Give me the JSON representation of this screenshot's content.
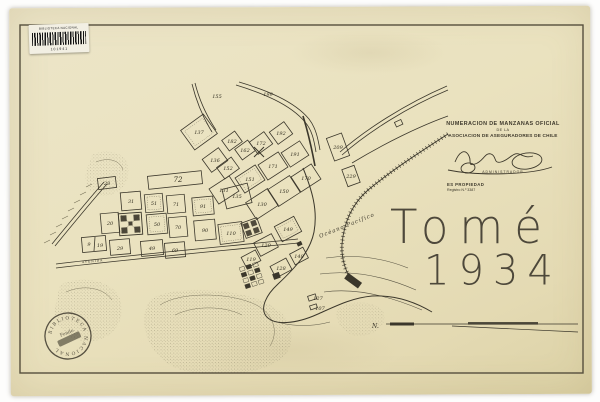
{
  "header": {
    "barcode_sticker": {
      "title": "BIBLIOTECA NACIONAL",
      "number": "101941"
    },
    "title_block": {
      "line1": "NUMERACION DE MANZANAS OFICIAL",
      "line2": "DE LA",
      "line3": "ASOCIACION DE ASEGURADORES DE CHILE",
      "signature_caption": "ADMINISTRADOR",
      "property_notice": "ES PROPIEDAD",
      "registry": "Registro N.º 3387"
    }
  },
  "map": {
    "title": "Tomé",
    "year": "1934",
    "ocean_label": "Océano Pacífico",
    "street_label": "AVENIDA",
    "north_label": "N.",
    "blocks": [
      {
        "n": "28",
        "x": 107,
        "y": 185
      },
      {
        "n": "72",
        "x": 178,
        "y": 182,
        "s": 7
      },
      {
        "n": "31",
        "x": 131,
        "y": 203
      },
      {
        "n": "51",
        "x": 154,
        "y": 205
      },
      {
        "n": "71",
        "x": 176,
        "y": 206
      },
      {
        "n": "91",
        "x": 203,
        "y": 208
      },
      {
        "n": "135",
        "x": 237,
        "y": 198
      },
      {
        "n": "20",
        "x": 110,
        "y": 225
      },
      {
        "n": "50",
        "x": 157,
        "y": 226
      },
      {
        "n": "70",
        "x": 178,
        "y": 229
      },
      {
        "n": "90",
        "x": 205,
        "y": 232
      },
      {
        "n": "110",
        "x": 231,
        "y": 235
      },
      {
        "n": "9",
        "x": 89,
        "y": 246
      },
      {
        "n": "19",
        "x": 100,
        "y": 247
      },
      {
        "n": "29",
        "x": 120,
        "y": 250
      },
      {
        "n": "49",
        "x": 152,
        "y": 250
      },
      {
        "n": "69",
        "x": 175,
        "y": 252
      },
      {
        "n": "137",
        "x": 199,
        "y": 134
      },
      {
        "n": "155",
        "x": 217,
        "y": 98
      },
      {
        "n": "199",
        "x": 268,
        "y": 96
      },
      {
        "n": "182",
        "x": 232,
        "y": 143
      },
      {
        "n": "162",
        "x": 245,
        "y": 152
      },
      {
        "n": "172",
        "x": 261,
        "y": 145
      },
      {
        "n": "192",
        "x": 281,
        "y": 135
      },
      {
        "n": "136",
        "x": 215,
        "y": 162
      },
      {
        "n": "152",
        "x": 228,
        "y": 170
      },
      {
        "n": "131",
        "x": 224,
        "y": 192
      },
      {
        "n": "151",
        "x": 250,
        "y": 181
      },
      {
        "n": "171",
        "x": 273,
        "y": 168
      },
      {
        "n": "191",
        "x": 295,
        "y": 156
      },
      {
        "n": "130",
        "x": 262,
        "y": 206
      },
      {
        "n": "150",
        "x": 284,
        "y": 193
      },
      {
        "n": "170",
        "x": 306,
        "y": 180
      },
      {
        "n": "149",
        "x": 288,
        "y": 231
      },
      {
        "n": "129",
        "x": 266,
        "y": 247
      },
      {
        "n": "119",
        "x": 251,
        "y": 261
      },
      {
        "n": "128",
        "x": 281,
        "y": 270
      },
      {
        "n": "148",
        "x": 299,
        "y": 258
      },
      {
        "n": "209",
        "x": 338,
        "y": 149
      },
      {
        "n": "229",
        "x": 351,
        "y": 178
      },
      {
        "n": "127",
        "x": 318,
        "y": 300
      },
      {
        "n": "107",
        "x": 320,
        "y": 310
      }
    ]
  },
  "stamp": {
    "ring_text": "BIBLIOTECA NACIONAL",
    "center_text": "Fondo"
  },
  "colors": {
    "paper": "#eae3c1",
    "ink": "#3b372b",
    "frame": "#564f3d"
  }
}
